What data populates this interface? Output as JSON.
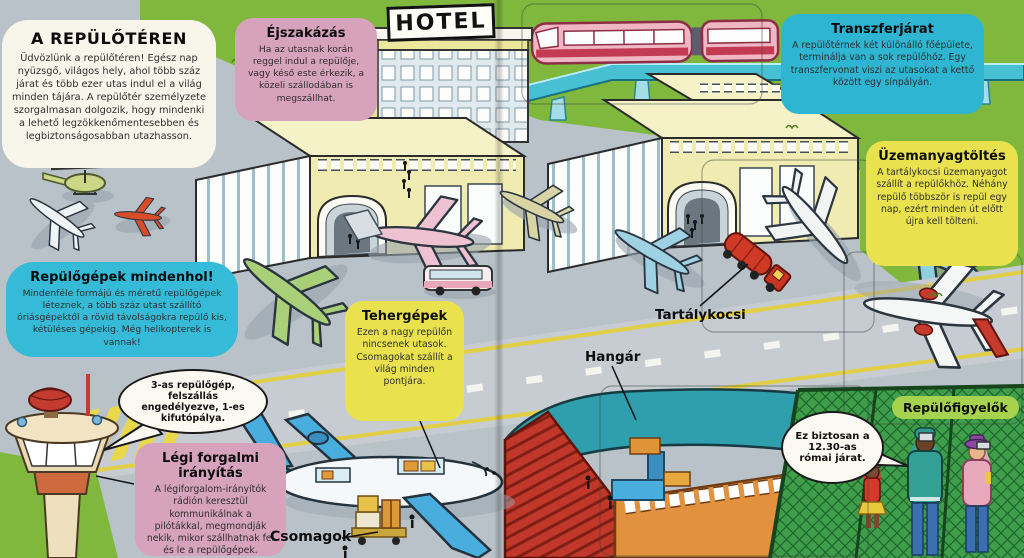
{
  "page": {
    "title": "A REPÜLŐTÉREN",
    "intro": "Üdvözlünk a repülőtéren! Egész nap nyüzsgő, világos hely, ahol több száz járat és több ezer utas indul el a világ minden tájára. A repülőtér személyzete szorgalmasan dolgozik, hogy mindenki a lehető legzökkenőmentesebben és legbiztonságosabban utazhasson."
  },
  "callouts": {
    "ejszakazas": {
      "title": "Éjszakázás",
      "body": "Ha az utasnak korán reggel indul a repülője, vagy késő este érkezik, a közeli szállodában is megszállhat."
    },
    "transzferjarat": {
      "title": "Transzferjárat",
      "body": "A repülőtérnek két különálló főépülete, terminálja van a sok repülőhöz. Egy transzfervonat viszi az utasokat a kettő között egy sínpályán."
    },
    "uzemanyagtoltes": {
      "title": "Üzemanyagtöltés",
      "body": "A tartálykocsi üzemanyagot szállít a repülőkhöz. Néhány repülő többször is repül egy nap, ezért minden út előtt újra kell tölteni."
    },
    "repulogepek_mindenhol": {
      "title": "Repülőgépek mindenhol!",
      "body": "Mindenféle formájú és méretű repülőgépek léteznek, a több száz utast szállító óriásgépektől a rövid távolságokra repülő kis, kétüléses gépekig. Még helikopterek is vannak!"
    },
    "tehergepek": {
      "title": "Tehergépek",
      "body": "Ezen a nagy repülőn nincsenek utasok. Csomagokat szállít a világ minden pontjára."
    },
    "legi_forgalmi_iranyitas": {
      "title": "Légi forgalmi irányítás",
      "body": "A légiforgalom-irányítók rádión keresztül kommunikálnak a pilótákkal, megmondják nekik, mikor szállhatnak fel és le a repülőgépek."
    }
  },
  "speech_bubbles": {
    "tower": "3-as repülőgép, felszállás engedélyezve, 1-es kifutópálya.",
    "spotter": "Ez biztosan a 12.30-as római járat."
  },
  "scene_labels": {
    "hotel_sign": "HOTEL",
    "tartalykocsi": "Tartálykocsi",
    "hangar": "Hangár",
    "csomagok": "Csomagok",
    "repulofigyelok": "Repülőfigyelők"
  },
  "colors": {
    "grass": "#7fb83d",
    "fence_grass": "#3f9e49",
    "tarmac": "#b9c2c9",
    "runway": "#c6ccd2",
    "runway_stripe_yellow": "#e3cf45",
    "bubble_pink": "#d7a2bc",
    "bubble_cyan": "#2eb5d2",
    "bubble_yellow": "#e9e24e",
    "bubble_green": "#a7d24d",
    "bubble_white": "#f8f5ea",
    "terminal_yellow": "#f0ebb0",
    "hangar_roof_teal": "#2f9fae",
    "hangar_door_red": "#c1372a",
    "hangar_wall_orange": "#e2913f",
    "train_pink": "#f0b6c4",
    "tanker_red": "#cf3a26"
  }
}
